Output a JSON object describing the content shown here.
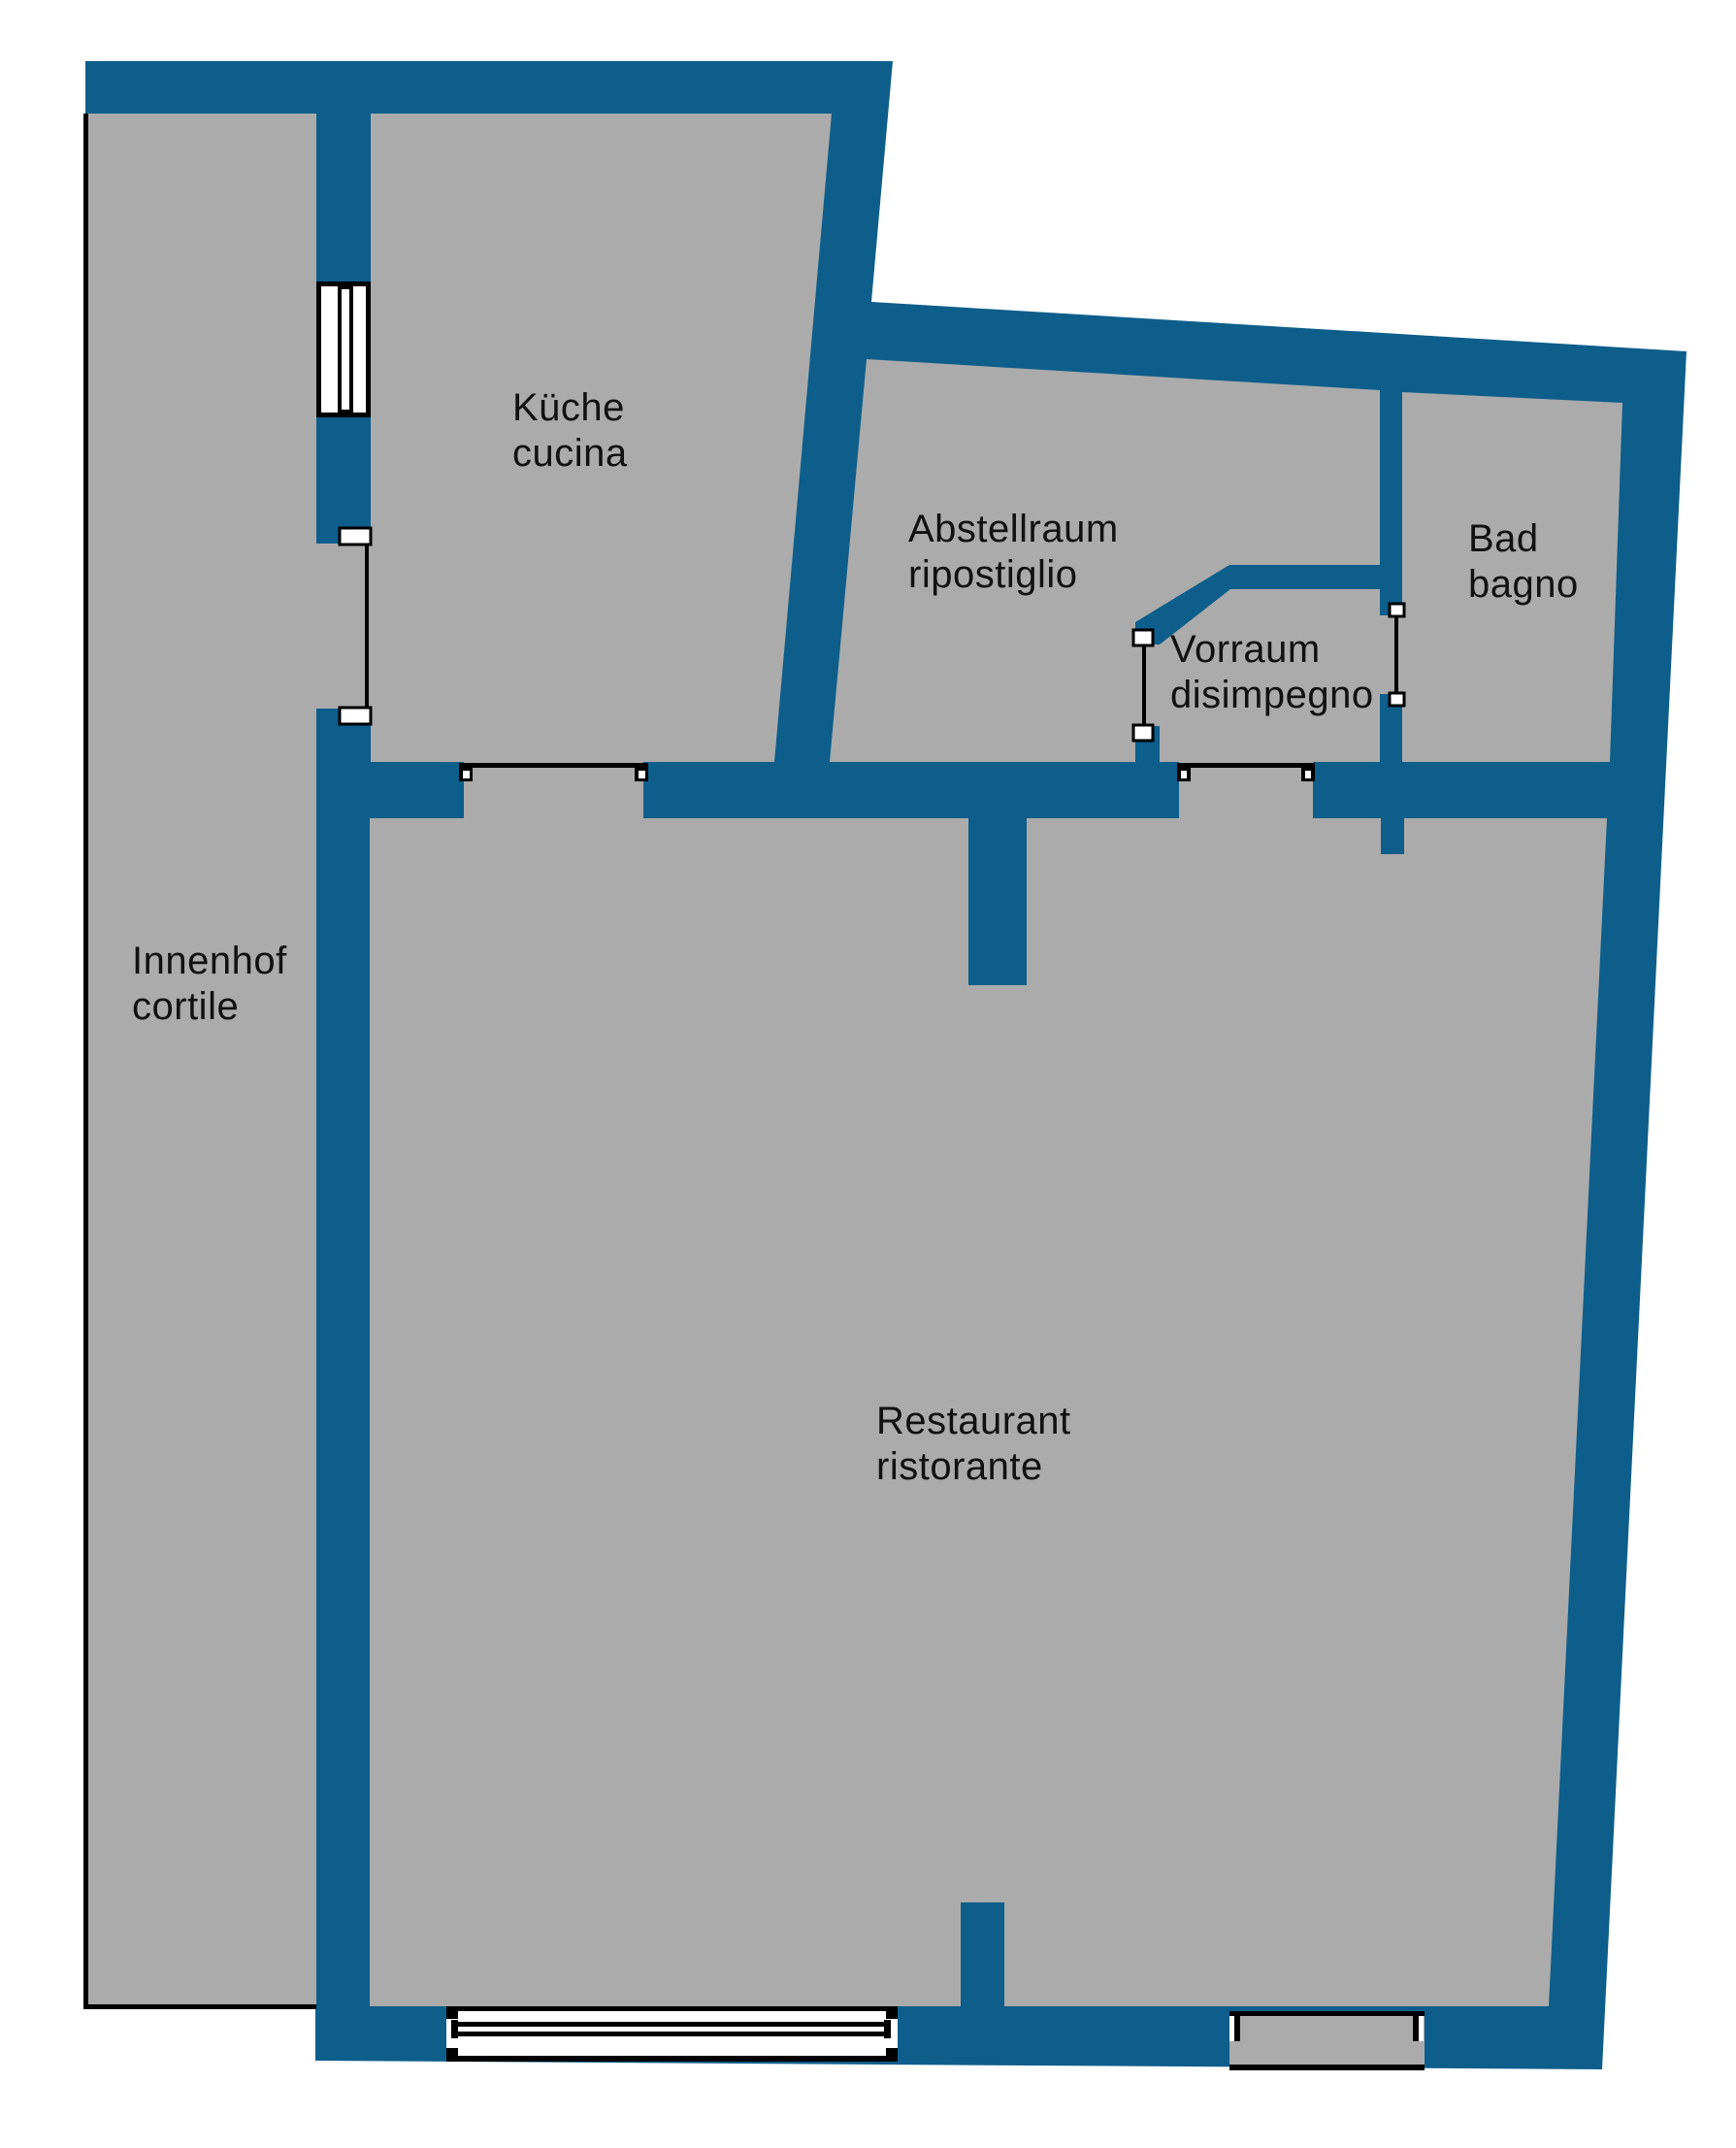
{
  "document": {
    "type": "floor-plan",
    "language_pair": "de-it"
  },
  "colors": {
    "wall": "#0d5e8b",
    "floor": "#ababab",
    "outside": "#ffffff",
    "line": "#000000",
    "opening_white": "#ffffff",
    "text": "#111111"
  },
  "rooms": [
    {
      "id": "innenhof",
      "label_de": "Innenhof",
      "label_it": "cortile"
    },
    {
      "id": "kueche",
      "label_de": "Küche",
      "label_it": "cucina"
    },
    {
      "id": "abstellraum",
      "label_de": "Abstellraum",
      "label_it": "ripostiglio"
    },
    {
      "id": "vorraum",
      "label_de": "Vorraum",
      "label_it": "disimpegno"
    },
    {
      "id": "bad",
      "label_de": "Bad",
      "label_it": "bagno"
    },
    {
      "id": "restaurant",
      "label_de": "Restaurant",
      "label_it": "ristorante"
    }
  ]
}
